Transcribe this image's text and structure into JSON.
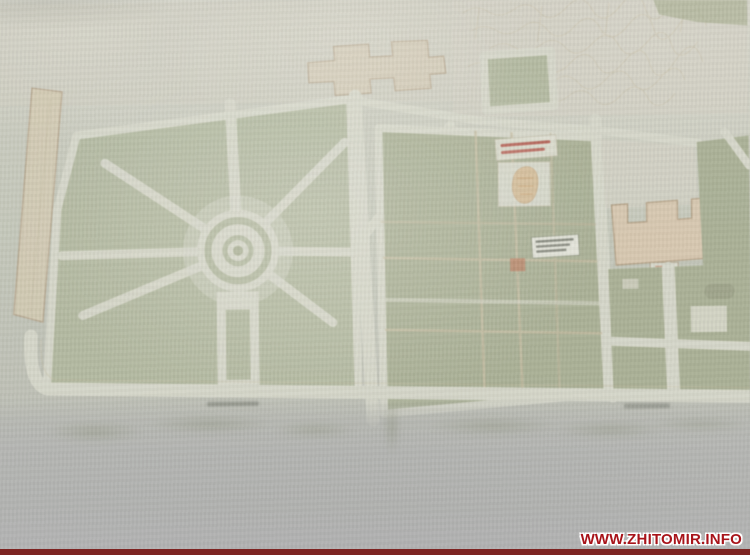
{
  "watermark": {
    "text": "WWW.ZHITOMIR.INFO"
  },
  "colors": {
    "wall": "#c5c8bb",
    "wall_light": "#cfcfc4",
    "floor": "#b5b6b3",
    "lawn": "#b3b99e",
    "lawn_dark": "#a9b092",
    "path": "#d8d9cb",
    "tan_line": "#c6bda0",
    "building_fill": "#d6cab1",
    "building_right_fill": "#dbc8ae",
    "building_outline": "#b5a184",
    "red_accent": "#c07a5a",
    "label_red": "#b03a2e",
    "smudge": "#6e7268",
    "watermark_red": "#a8141a",
    "watermark_bar": "#7d2422"
  }
}
